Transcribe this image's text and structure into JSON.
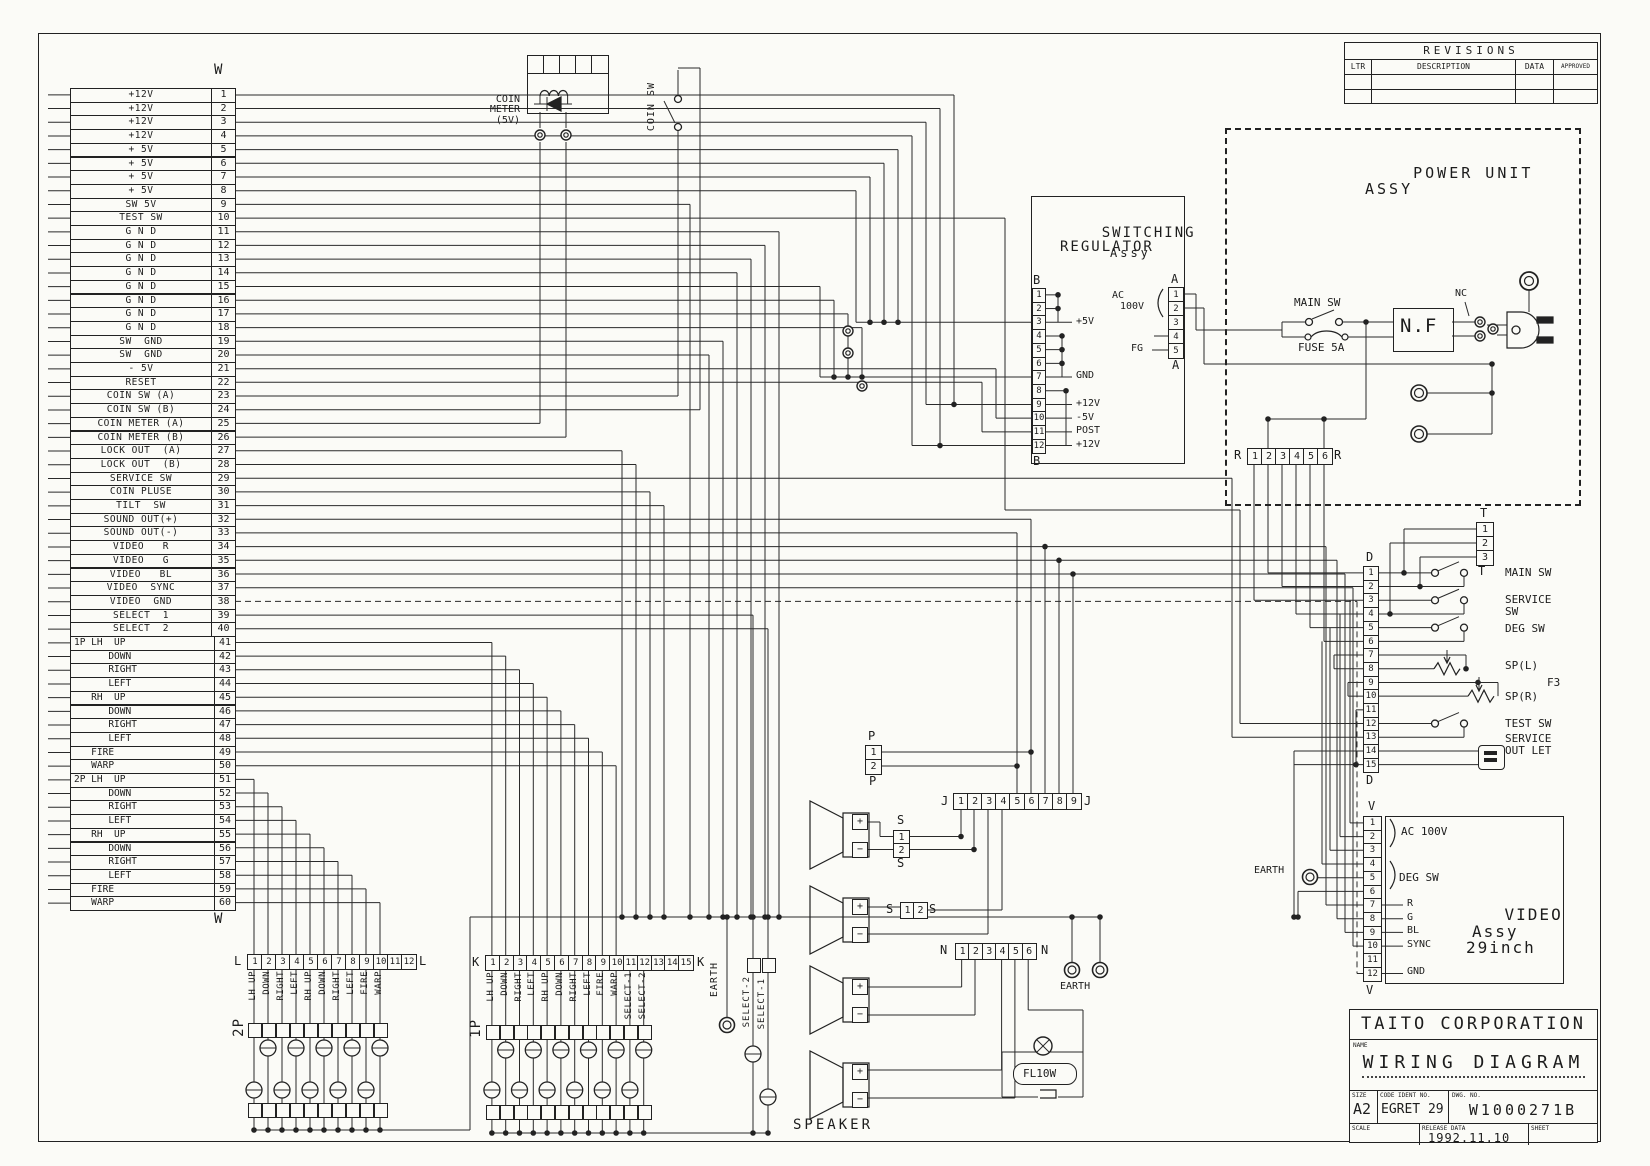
{
  "sheet": {
    "w_connector": {
      "letter": "W",
      "rows": [
        {
          "pin": "1",
          "label": "+12V"
        },
        {
          "pin": "2",
          "label": "+12V"
        },
        {
          "pin": "3",
          "label": "+12V"
        },
        {
          "pin": "4",
          "label": "+12V"
        },
        {
          "pin": "5",
          "label": "+ 5V"
        },
        {
          "pin": "6",
          "label": "+ 5V"
        },
        {
          "pin": "7",
          "label": "+ 5V"
        },
        {
          "pin": "8",
          "label": "+ 5V"
        },
        {
          "pin": "9",
          "label": "SW 5V"
        },
        {
          "pin": "10",
          "label": "TEST SW"
        },
        {
          "pin": "11",
          "label": "G N D"
        },
        {
          "pin": "12",
          "label": "G N D"
        },
        {
          "pin": "13",
          "label": "G N D"
        },
        {
          "pin": "14",
          "label": "G N D"
        },
        {
          "pin": "15",
          "label": "G N D"
        },
        {
          "pin": "16",
          "label": "G N D"
        },
        {
          "pin": "17",
          "label": "G N D"
        },
        {
          "pin": "18",
          "label": "G N D"
        },
        {
          "pin": "19",
          "label": "SW  GND"
        },
        {
          "pin": "20",
          "label": "SW  GND"
        },
        {
          "pin": "21",
          "label": "- 5V"
        },
        {
          "pin": "22",
          "label": "RESET"
        },
        {
          "pin": "23",
          "label": "COIN SW (A)"
        },
        {
          "pin": "24",
          "label": "COIN SW (B)"
        },
        {
          "pin": "25",
          "label": "COIN METER (A)"
        },
        {
          "pin": "26",
          "label": "COIN METER (B)"
        },
        {
          "pin": "27",
          "label": "LOCK OUT  (A)"
        },
        {
          "pin": "28",
          "label": "LOCK OUT  (B)"
        },
        {
          "pin": "29",
          "label": "SERVICE SW"
        },
        {
          "pin": "30",
          "label": "COIN PLUSE"
        },
        {
          "pin": "31",
          "label": "TILT  SW"
        },
        {
          "pin": "32",
          "label": "SOUND OUT(+)"
        },
        {
          "pin": "33",
          "label": "SOUND OUT(-)"
        },
        {
          "pin": "34",
          "label": "VIDEO   R"
        },
        {
          "pin": "35",
          "label": "VIDEO   G"
        },
        {
          "pin": "36",
          "label": "VIDEO   BL"
        },
        {
          "pin": "37",
          "label": "VIDEO  SYNC"
        },
        {
          "pin": "38",
          "label": "VIDEO  GND"
        },
        {
          "pin": "39",
          "label": "SELECT  1"
        },
        {
          "pin": "40",
          "label": "SELECT  2"
        },
        {
          "pin": "41",
          "label": "1P LH  UP"
        },
        {
          "pin": "42",
          "label": "      DOWN"
        },
        {
          "pin": "43",
          "label": "      RIGHT"
        },
        {
          "pin": "44",
          "label": "      LEFT"
        },
        {
          "pin": "45",
          "label": "   RH  UP"
        },
        {
          "pin": "46",
          "label": "      DOWN"
        },
        {
          "pin": "47",
          "label": "      RIGHT"
        },
        {
          "pin": "48",
          "label": "      LEFT"
        },
        {
          "pin": "49",
          "label": "   FIRE"
        },
        {
          "pin": "50",
          "label": "   WARP"
        },
        {
          "pin": "51",
          "label": "2P LH  UP"
        },
        {
          "pin": "52",
          "label": "      DOWN"
        },
        {
          "pin": "53",
          "label": "      RIGHT"
        },
        {
          "pin": "54",
          "label": "      LEFT"
        },
        {
          "pin": "55",
          "label": "   RH  UP"
        },
        {
          "pin": "56",
          "label": "      DOWN"
        },
        {
          "pin": "57",
          "label": "      RIGHT"
        },
        {
          "pin": "58",
          "label": "      LEFT"
        },
        {
          "pin": "59",
          "label": "   FIRE"
        },
        {
          "pin": "60",
          "label": "   WARP"
        }
      ]
    },
    "coin_meter": {
      "line1": "COIN",
      "line2": "METER",
      "line3": "(5V)"
    },
    "coin_sw_label": "COIN SW",
    "switching_regulator": {
      "title1": "SWITCHING",
      "title2": "REGULATOR",
      "title3": "Assy",
      "b_letter": "B",
      "b_pins": [
        "1",
        "2",
        "3",
        "4",
        "5",
        "6",
        "7",
        "8",
        "9",
        "10",
        "11",
        "12"
      ],
      "label_5v": "+5V",
      "label_gnd": "GND",
      "label_12v": "+12V",
      "label_m5v": "-5V",
      "label_post": "POST",
      "label_12v2": "+12V",
      "a_letter": "A",
      "a_pins": [
        "1",
        "2",
        "3",
        "4",
        "5"
      ],
      "ac1": "AC",
      "ac2": "100V",
      "fg": "FG"
    },
    "power_unit": {
      "title1": "POWER UNIT",
      "title2": "ASSY",
      "main_sw": "MAIN SW",
      "fuse": "FUSE 5A",
      "nf": "N.F",
      "nc": "NC",
      "r_letter": "R",
      "r_pins": [
        "1",
        "2",
        "3",
        "4",
        "5",
        "6"
      ]
    },
    "t_connector": {
      "letter": "T",
      "pins": [
        "1",
        "2",
        "3"
      ]
    },
    "d_connector": {
      "letter": "D",
      "pins": [
        "1",
        "2",
        "3",
        "4",
        "5",
        "6",
        "7",
        "8",
        "9",
        "10",
        "11",
        "12",
        "13",
        "14",
        "15"
      ],
      "main_sw": "MAIN SW",
      "service1": "SERVICE",
      "service2": "SW",
      "deg_sw": "DEG SW",
      "sp_l": "SP(L)",
      "f3": "F3",
      "sp_r": "SP(R)",
      "test_sw": "TEST SW",
      "outlet1": "SERVICE",
      "outlet2": "OUT LET"
    },
    "v_connector": {
      "letter": "V",
      "pins": [
        "1",
        "2",
        "3",
        "4",
        "5",
        "6",
        "7",
        "8",
        "9",
        "10",
        "11",
        "12"
      ],
      "ac": "AC 100V",
      "deg": "DEG SW",
      "r": "R",
      "g": "G",
      "bl": "BL",
      "sync": "SYNC",
      "gnd": "GND",
      "earth": "EARTH"
    },
    "video_assy": {
      "line1": "VIDEO",
      "line2": "Assy",
      "line3": "29inch"
    },
    "p_connector": {
      "letter": "P",
      "pins": [
        "1",
        "2"
      ]
    },
    "j_connector": {
      "letter": "J",
      "pins": [
        "1",
        "2",
        "3",
        "4",
        "5",
        "6",
        "7",
        "8",
        "9"
      ]
    },
    "s_connector_v": {
      "letter": "S",
      "pins": [
        "1",
        "2"
      ]
    },
    "s_connector_h": {
      "letter": "S",
      "pins": [
        "1",
        "2"
      ]
    },
    "n_connector": {
      "letter": "N",
      "pins": [
        "1",
        "2",
        "3",
        "4",
        "5",
        "6"
      ]
    },
    "speaker_label": "SPEAKER",
    "fl_lamp": "FL10W",
    "earth_n": "EARTH",
    "earth_k": "EARTH",
    "select_col_left": "SELECT-2",
    "select_col_right": "SELECT-1",
    "l_connector": {
      "letter": "L",
      "group": "2P",
      "pins": [
        "1",
        "2",
        "3",
        "4",
        "5",
        "6",
        "7",
        "8",
        "9",
        "10",
        "11",
        "12"
      ],
      "pin_labels": [
        "LH UP",
        "DOWN",
        "RIGHT",
        "LEFT",
        "RH UP",
        "DOWN",
        "RIGHT",
        "LEFT",
        "FIRE",
        "WARP"
      ]
    },
    "k_connector": {
      "letter": "K",
      "group": "1P",
      "pins": [
        "1",
        "2",
        "3",
        "4",
        "5",
        "6",
        "7",
        "8",
        "9",
        "10",
        "11",
        "12",
        "13",
        "14",
        "15"
      ],
      "pin_labels": [
        "LH UP",
        "DOWN",
        "RIGHT",
        "LEFT",
        "RH UP",
        "DOWN",
        "RIGHT",
        "LEFT",
        "FIRE",
        "WARP",
        "SELECT-1",
        "SELECT-2"
      ]
    },
    "revisions": {
      "title": "REVISIONS",
      "headers": [
        "LTR",
        "DESCRIPTION",
        "DATA",
        "APPROVED"
      ]
    },
    "title_block": {
      "company": "TAITO  CORPORATION",
      "name_label": "NAME",
      "name": "WIRING DIAGRAM",
      "size_label": "SIZE",
      "size": "A2",
      "code_label": "CODE IDENT NO.",
      "code": "EGRET 29",
      "dwg_label": "DWG. NO.",
      "dwg_no": "W1000271B",
      "scale_label": "SCALE",
      "release_label": "RELEASE DATA",
      "release_date": "1992.11.10",
      "sheet_label": "SHEET"
    }
  }
}
